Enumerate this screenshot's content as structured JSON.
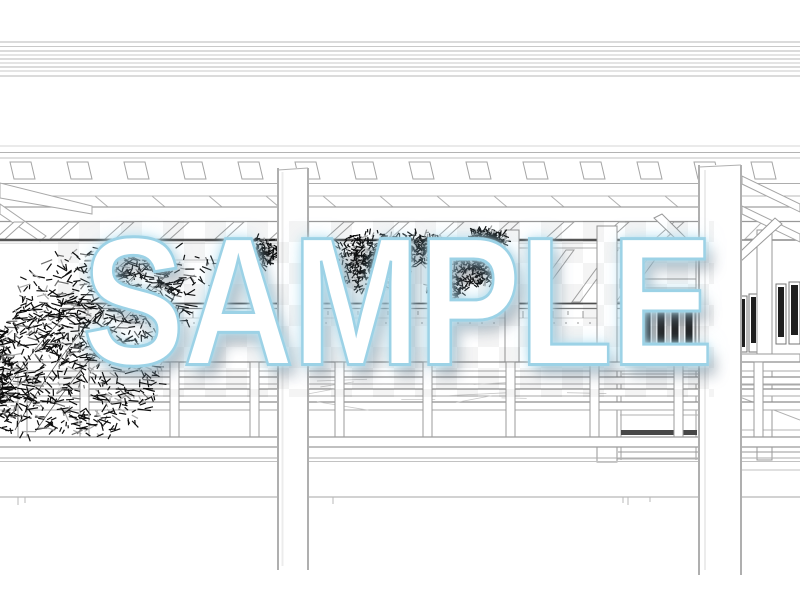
{
  "watermark": {
    "text": "SAMPLE",
    "fill_color": "#ffffff",
    "outline_color": "#9cd2e6",
    "glow_color": "#bde4f2",
    "shadow_color": "rgba(100,115,130,0.40)",
    "checker_cell_px": 21
  },
  "scene": {
    "subject": "monochrome line-art illustration of a traditional Japanese wooden temple corridor with round pillars, eave rafters, a balustrade railing, a bamboo grove on the left and pine branches in the center",
    "background_color": "#ffffff",
    "line_color": "#9a9a9a",
    "fine_line_color": "#c9c9c9",
    "dark_accent_color": "#555555",
    "window_panel_color": "#1f1f1f",
    "foliage_color": "#0d0d0d",
    "foliage_highlight_color": "#9c9c9c"
  }
}
